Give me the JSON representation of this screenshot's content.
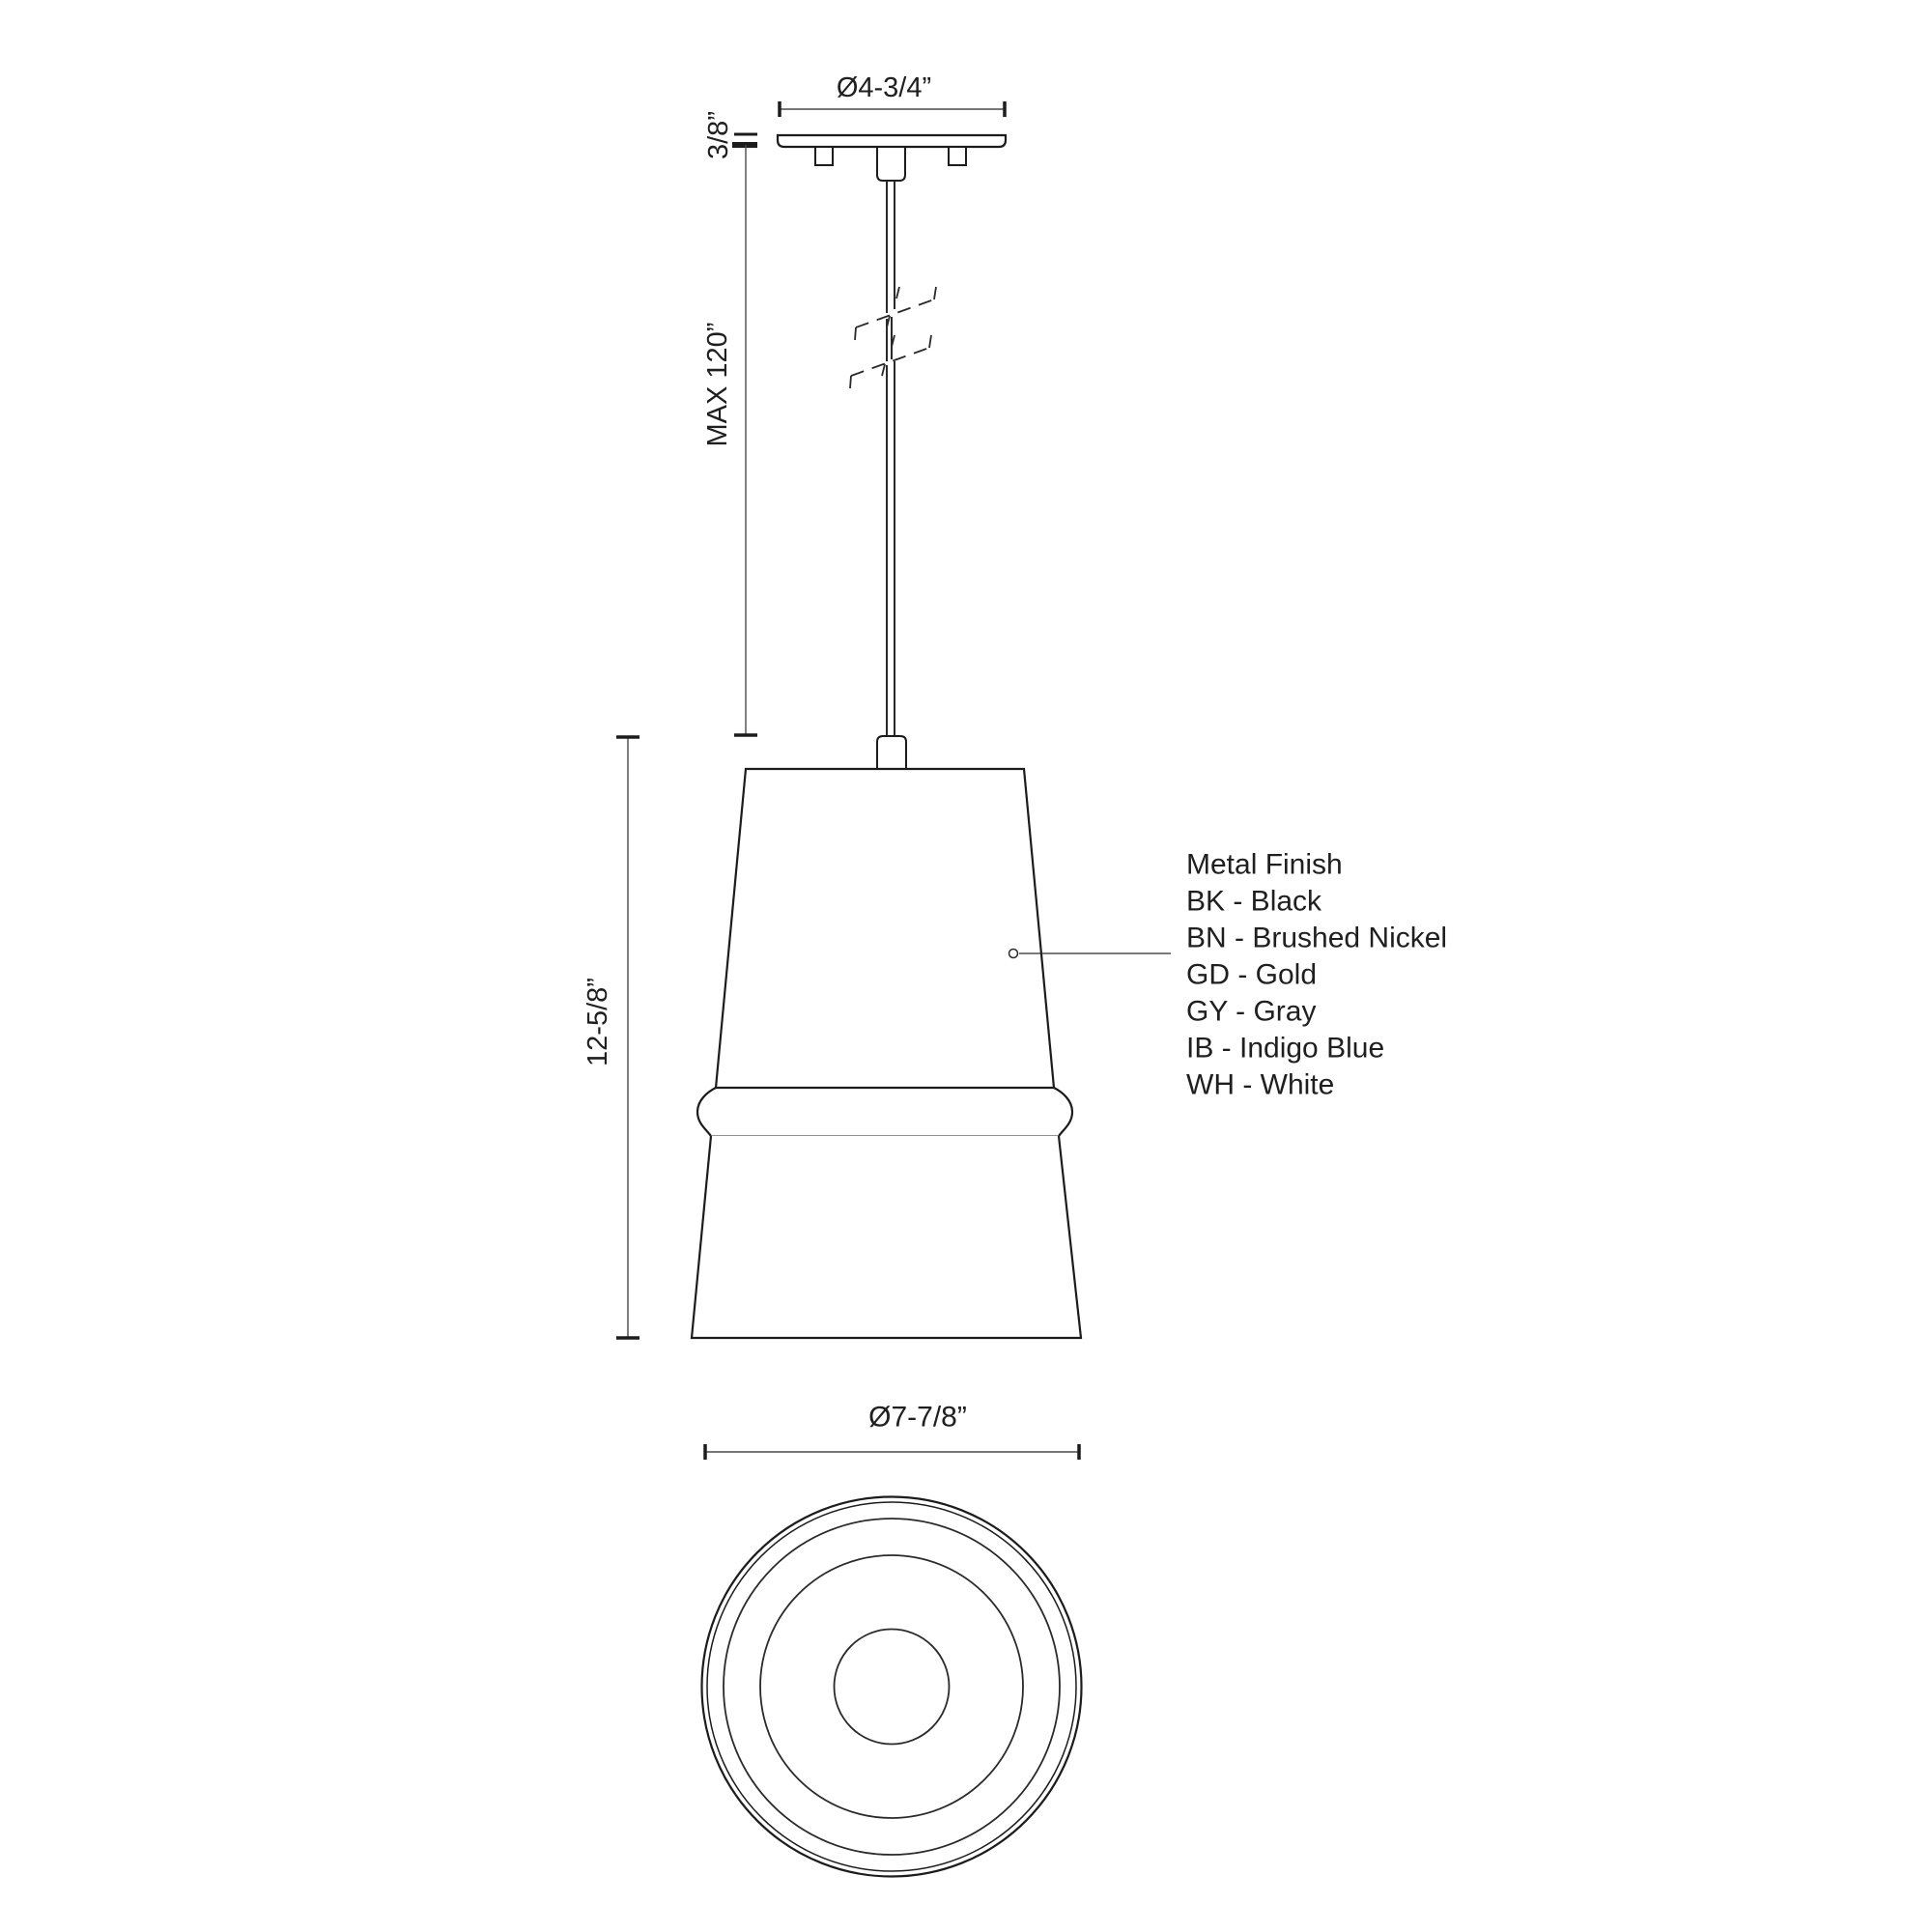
{
  "drawing": {
    "kind": "pendant-light-technical-dimension-drawing",
    "background": "#ffffff",
    "line_color": "#1c1c1c",
    "dim_line_color": "#4a4a4a",
    "thin_line_color": "#6e6e6e",
    "text_color": "#1f1f1f"
  },
  "side_view": {
    "canopy_diameter_label": "Ø4-3/4”",
    "canopy_height_label": "3/8”",
    "cord_length_label": "MAX 120”",
    "fixture_height_label": "12-5/8”"
  },
  "bottom_view": {
    "shade_diameter_label": "Ø7-7/8”"
  },
  "finish_legend": {
    "title": "Metal Finish",
    "options": [
      {
        "code": "BK",
        "name": "Black",
        "label": "BK - Black"
      },
      {
        "code": "BN",
        "name": "Brushed Nickel",
        "label": "BN - Brushed Nickel"
      },
      {
        "code": "GD",
        "name": "Gold",
        "label": "GD - Gold"
      },
      {
        "code": "GY",
        "name": "Gray",
        "label": "GY - Gray"
      },
      {
        "code": "IB",
        "name": "Indigo Blue",
        "label": "IB - Indigo Blue"
      },
      {
        "code": "WH",
        "name": "White",
        "label": "WH - White"
      }
    ]
  }
}
